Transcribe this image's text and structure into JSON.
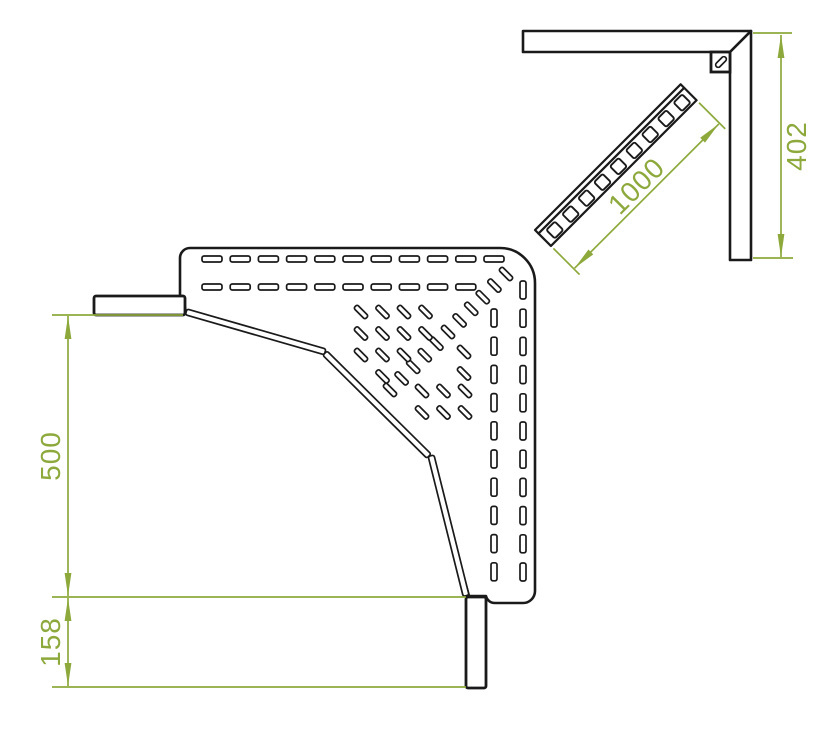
{
  "page": {
    "background": "#ffffff"
  },
  "drawing": {
    "title": "cable-tray-90-degree-corner-technical-drawing",
    "colors": {
      "line": "#1a1a1a",
      "dimension": "#8da93c",
      "fill": "#ffffff"
    },
    "top_view": {
      "dimensions": {
        "width_500": "500",
        "offset_158": "158"
      }
    },
    "side_view": {
      "dimensions": {
        "strut_1000": "1000",
        "height_402": "402"
      }
    },
    "perforations": {
      "h_slot": {
        "w": 20,
        "h": 6
      },
      "v_slot": {
        "w": 6,
        "h": 18
      },
      "diag_slot": {
        "w": 16,
        "h": 5
      },
      "h_rows": [
        {
          "y": 256,
          "x0": 202,
          "pitch": 28.2,
          "count": 11
        },
        {
          "y": 284,
          "x0": 202,
          "pitch": 28.2,
          "count": 10
        }
      ],
      "v_cols": [
        {
          "x": 491,
          "y0": 309,
          "pitch": 28.2,
          "count": 10
        },
        {
          "x": 520,
          "y0": 281,
          "pitch": 28.2,
          "count": 11
        }
      ],
      "diag_line": {
        "x0": 506,
        "y0": 274,
        "step": 11.6,
        "count": 11
      },
      "diag_scatter": [
        [
          361,
          312
        ],
        [
          382.5,
          312
        ],
        [
          404,
          312
        ],
        [
          425.5,
          312
        ],
        [
          361,
          333.5
        ],
        [
          382.5,
          333.5
        ],
        [
          404,
          333.5
        ],
        [
          425.5,
          333.5
        ],
        [
          361,
          355
        ],
        [
          382.5,
          355
        ],
        [
          404,
          355
        ],
        [
          382.5,
          376.5
        ],
        [
          464,
          352
        ],
        [
          464,
          373.5
        ],
        [
          422,
          391
        ],
        [
          443.5,
          391
        ],
        [
          465,
          391
        ],
        [
          422,
          412.5
        ],
        [
          443.5,
          412.5
        ],
        [
          465,
          412.5
        ]
      ],
      "strut_rungs": {
        "count": 9,
        "x0": 8,
        "pitch": 22.5,
        "y": 8,
        "size": 12
      }
    }
  }
}
